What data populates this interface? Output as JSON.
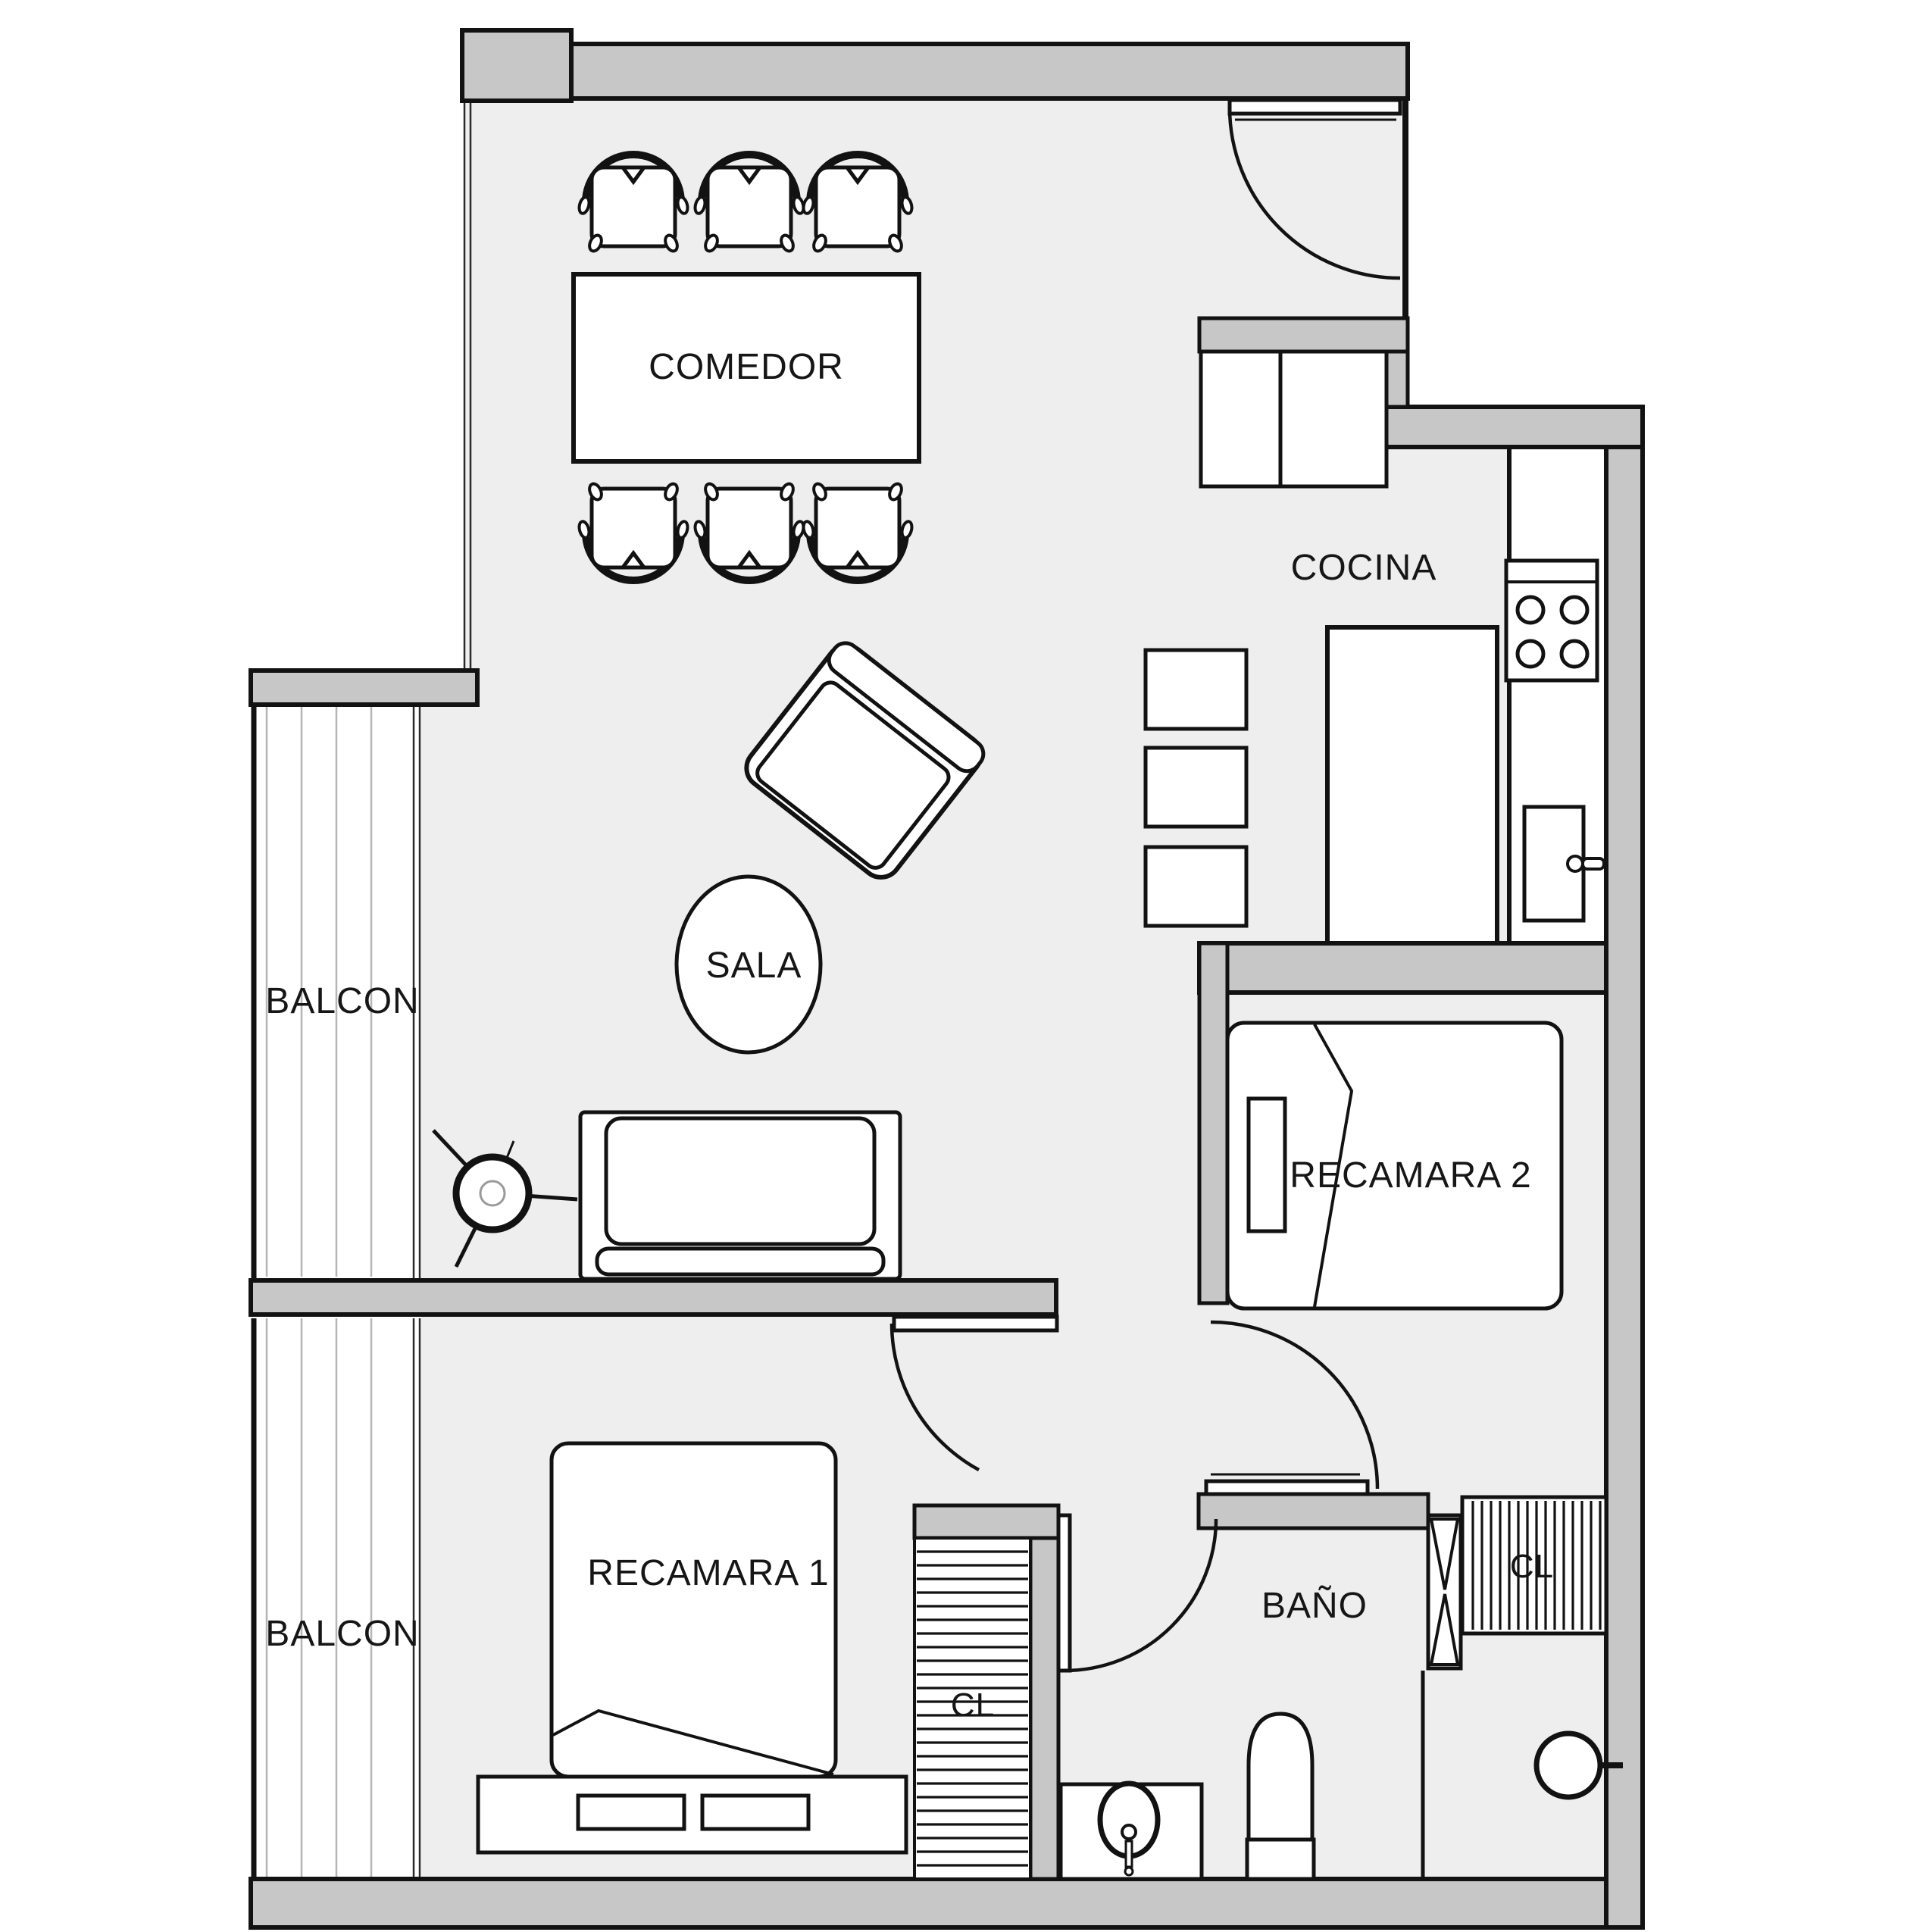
{
  "title": "Apartment floor plan",
  "colors": {
    "wall_fill": "#c7c7c7",
    "floor_fill": "#eeeeee",
    "line": "#121212",
    "deck_line": "#b5b5b5"
  },
  "rooms": {
    "comedor": {
      "label": "COMEDOR"
    },
    "cocina": {
      "label": "COCINA"
    },
    "sala": {
      "label": "SALA"
    },
    "balcon_upper": {
      "label": "BALCON"
    },
    "balcon_lower": {
      "label": "BALCON"
    },
    "recamara1": {
      "label": "RECAMARA 1"
    },
    "recamara2": {
      "label": "RECAMARA 2"
    },
    "bano": {
      "label": "BAÑO"
    },
    "closet_left": {
      "label": "CL"
    },
    "closet_right": {
      "label": "CL"
    }
  }
}
